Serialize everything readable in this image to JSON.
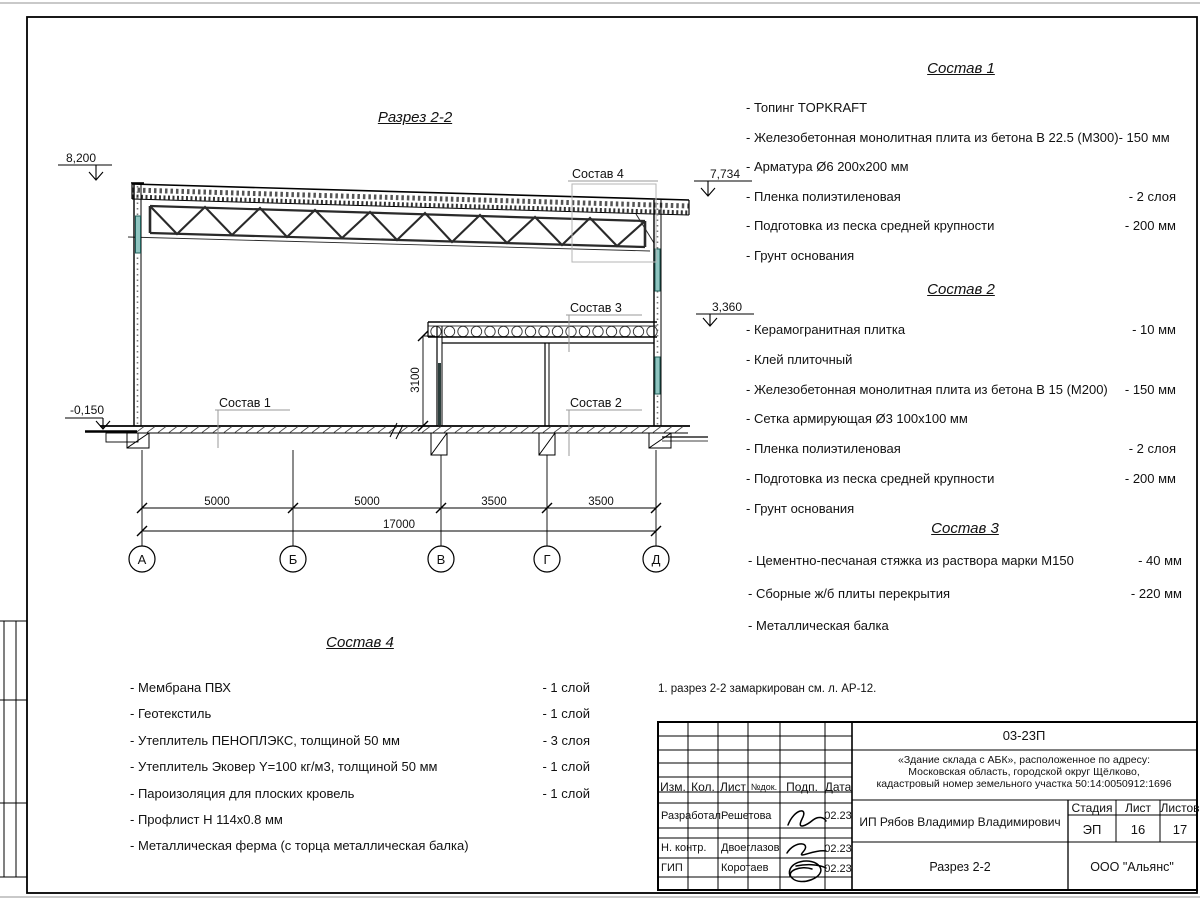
{
  "colors": {
    "window_fill": "#8fc4c0",
    "window_stroke": "#1f5f5a",
    "leader_gray": "#9a9a9a"
  },
  "drawing": {
    "title": "Разрез 2-2",
    "elevations": {
      "roof_left": "8,200",
      "roof_right": "7,734",
      "slab": "3,360",
      "ground": "-0,150"
    },
    "callouts": {
      "c1": "Состав 1",
      "c2": "Состав 2",
      "c3": "Состав 3",
      "c4": "Состав 4"
    },
    "dims": {
      "spans": [
        "5000",
        "5000",
        "3500",
        "3500"
      ],
      "total": "17000",
      "height": "3100"
    },
    "axes": [
      "А",
      "Б",
      "В",
      "Г",
      "Д"
    ]
  },
  "note": "1. разрез 2-2 замаркирован см. л. АР-12.",
  "compositions": [
    {
      "title": "Состав 1",
      "items": [
        {
          "n": "- Топинг TOPKRAFT",
          "v": ""
        },
        {
          "n": "- Железобетонная  монолитная плита из бетона  В 22.5 (М300)- 150 мм",
          "v": ""
        },
        {
          "n": "- Арматура Ø6 200x200 мм",
          "v": ""
        },
        {
          "n": "- Пленка полиэтиленовая",
          "v": "-  2 слоя"
        },
        {
          "n": "- Подготовка из песка средней  крупности",
          "v": "- 200 мм"
        },
        {
          "n": "- Грунт основания",
          "v": ""
        }
      ]
    },
    {
      "title": "Состав 2",
      "items": [
        {
          "n": "- Керамогранитная плитка",
          "v": "- 10 мм"
        },
        {
          "n": "- Клей плиточный",
          "v": ""
        },
        {
          "n": "- Железобетонная  монолитная плита из бетона В 15 (М200)",
          "v": "- 150 мм"
        },
        {
          "n": "- Сетка армирующая Ø3 100x100 мм",
          "v": ""
        },
        {
          "n": "- Пленка полиэтиленовая",
          "v": "-  2 слоя"
        },
        {
          "n": "- Подготовка из песка средней  крупности",
          "v": "- 200 мм"
        },
        {
          "n": "- Грунт основания",
          "v": ""
        }
      ]
    },
    {
      "title": "Состав 3",
      "items": [
        {
          "n": "- Цементно-песчаная стяжка  из раствора марки М150",
          "v": "- 40 мм"
        },
        {
          "n": "- Сборные ж/б плиты перекрытия",
          "v": "- 220 мм"
        },
        {
          "n": "- Металлическая  балка",
          "v": ""
        }
      ]
    },
    {
      "title": "Состав 4",
      "items": [
        {
          "n": "- Мембрана ПВХ",
          "v": "- 1 слой"
        },
        {
          "n": "- Геотекстиль",
          "v": "- 1 слой"
        },
        {
          "n": "- Утеплитель ПЕНОПЛЭКС, толщиной 50 мм",
          "v": "- 3 слоя"
        },
        {
          "n": "- Утеплитель Эковер Y=100 кг/м3, толщиной 50 мм",
          "v": "- 1 слой"
        },
        {
          "n": "- Пароизоляция для плоских кровель",
          "v": "- 1 слой"
        },
        {
          "n": "- Профлист Н 114x0.8 мм",
          "v": ""
        },
        {
          "n": "- Металлическая ферма (с торца металлическая балка)",
          "v": ""
        }
      ]
    }
  ],
  "titleblock": {
    "code": "03-23П",
    "project_lines": [
      "«Здание склада с АБК», расположенное по адресу:",
      "Московская область, городской округ Щёлково,",
      "кадастровый номер земельного участка 50:14:0050912:1696"
    ],
    "columns": [
      "Изм.",
      "Кол.",
      "Лист",
      "№док.",
      "Подп.",
      "Дата"
    ],
    "rows": [
      {
        "role": "Разработал",
        "name": "Решетова",
        "date": "02.23"
      },
      {
        "role": "Н. контр.",
        "name": "Двоеглазов",
        "date": "02.23"
      },
      {
        "role": "ГИП",
        "name": "Коротаев",
        "date": "02.23"
      }
    ],
    "client": "ИП Рябов Владимир Владимирович",
    "stage_header": [
      "Стадия",
      "Лист",
      "Листов"
    ],
    "stage": "ЭП",
    "sheet": "16",
    "sheets": "17",
    "sheet_name": "Разрез 2-2",
    "company": "ООО \"Альянс\""
  }
}
